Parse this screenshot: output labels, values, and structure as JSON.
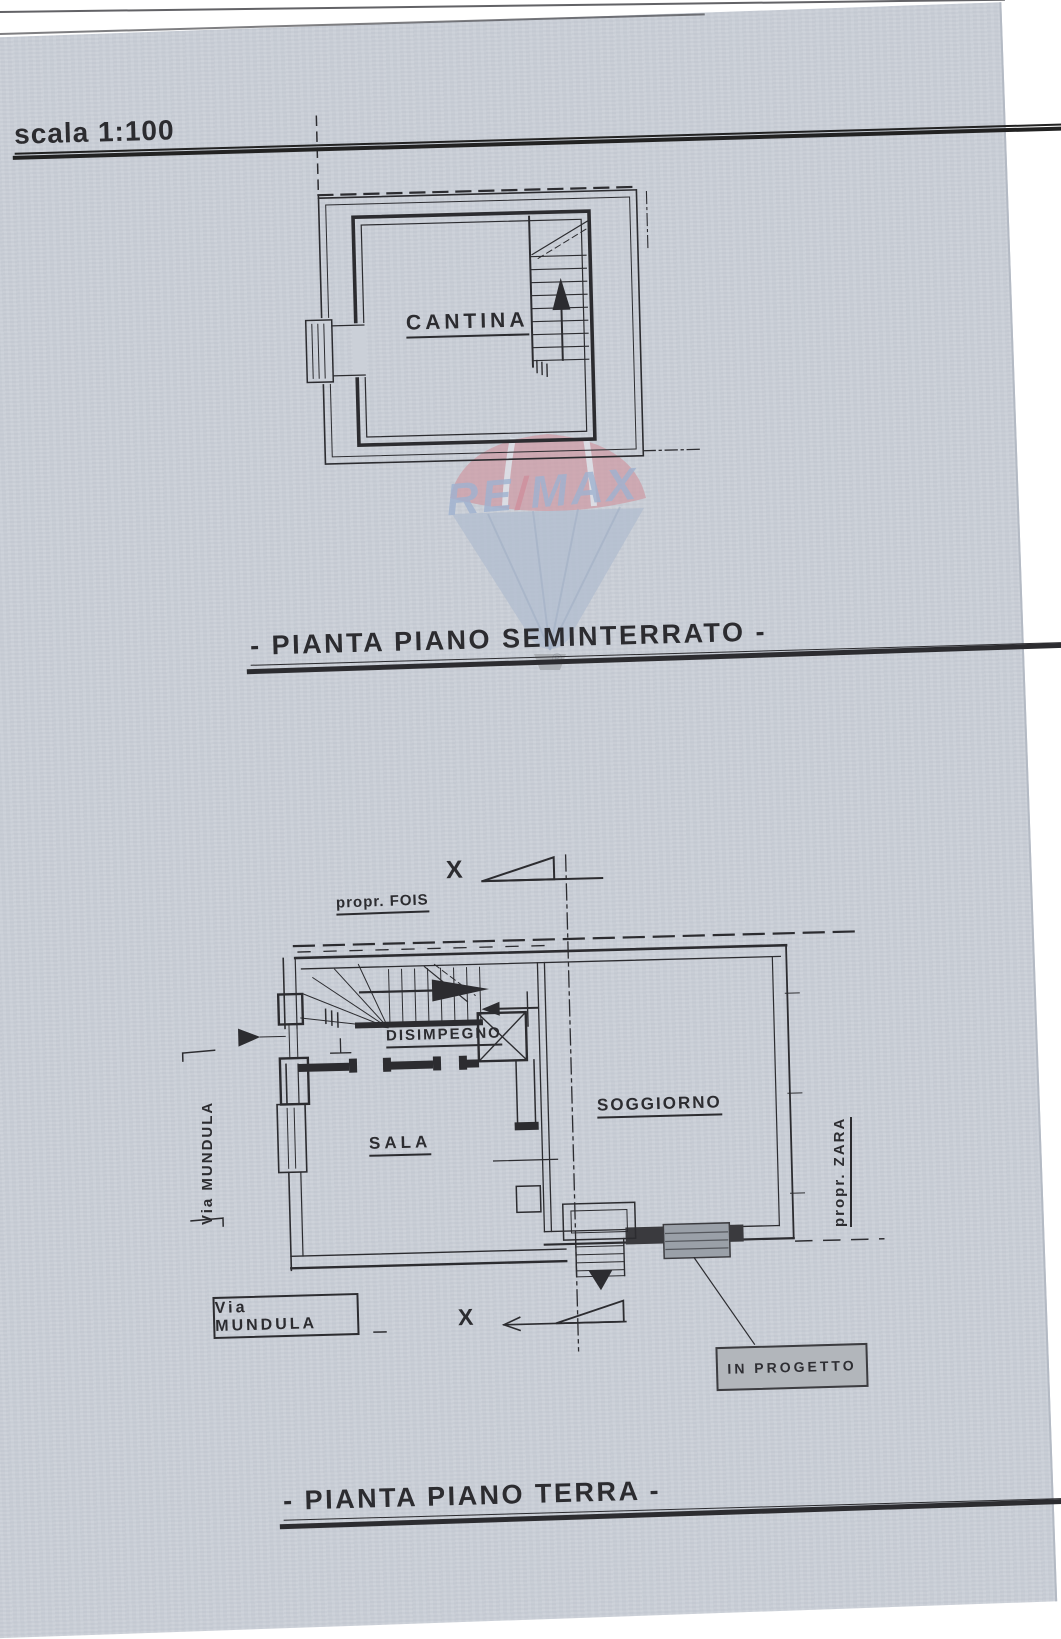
{
  "document": {
    "scale_note": "scala 1:100"
  },
  "watermark": {
    "re": "RE",
    "slash": "/",
    "max": "MAX",
    "registered": "®",
    "blue": "#9fb2d0",
    "red": "#cf8f9c"
  },
  "seminterrato": {
    "title": "- PIANTA PIANO SEMINTERRATO -",
    "room_cantina": "CANTINA"
  },
  "terra": {
    "title": "- PIANTA PIANO TERRA -",
    "room_disimpegno": "DISIMPEGNO",
    "room_sala": "SALA",
    "room_soggiorno": "SOGGIORNO",
    "neighbor_north": "propr. FOIS",
    "neighbor_east": "propr. ZARA",
    "street_side": "Via MUNDULA",
    "street_box": "Via MUNDULA",
    "annotation_in_progetto": "IN PROGETTO",
    "section_marker_top": "X",
    "section_marker_bottom": "X"
  },
  "colors": {
    "paper": "#cbd0d8",
    "ink": "#2c2c30",
    "progetto_fill": "#b2b6bb",
    "steps_fill": "#9aa0a8"
  }
}
